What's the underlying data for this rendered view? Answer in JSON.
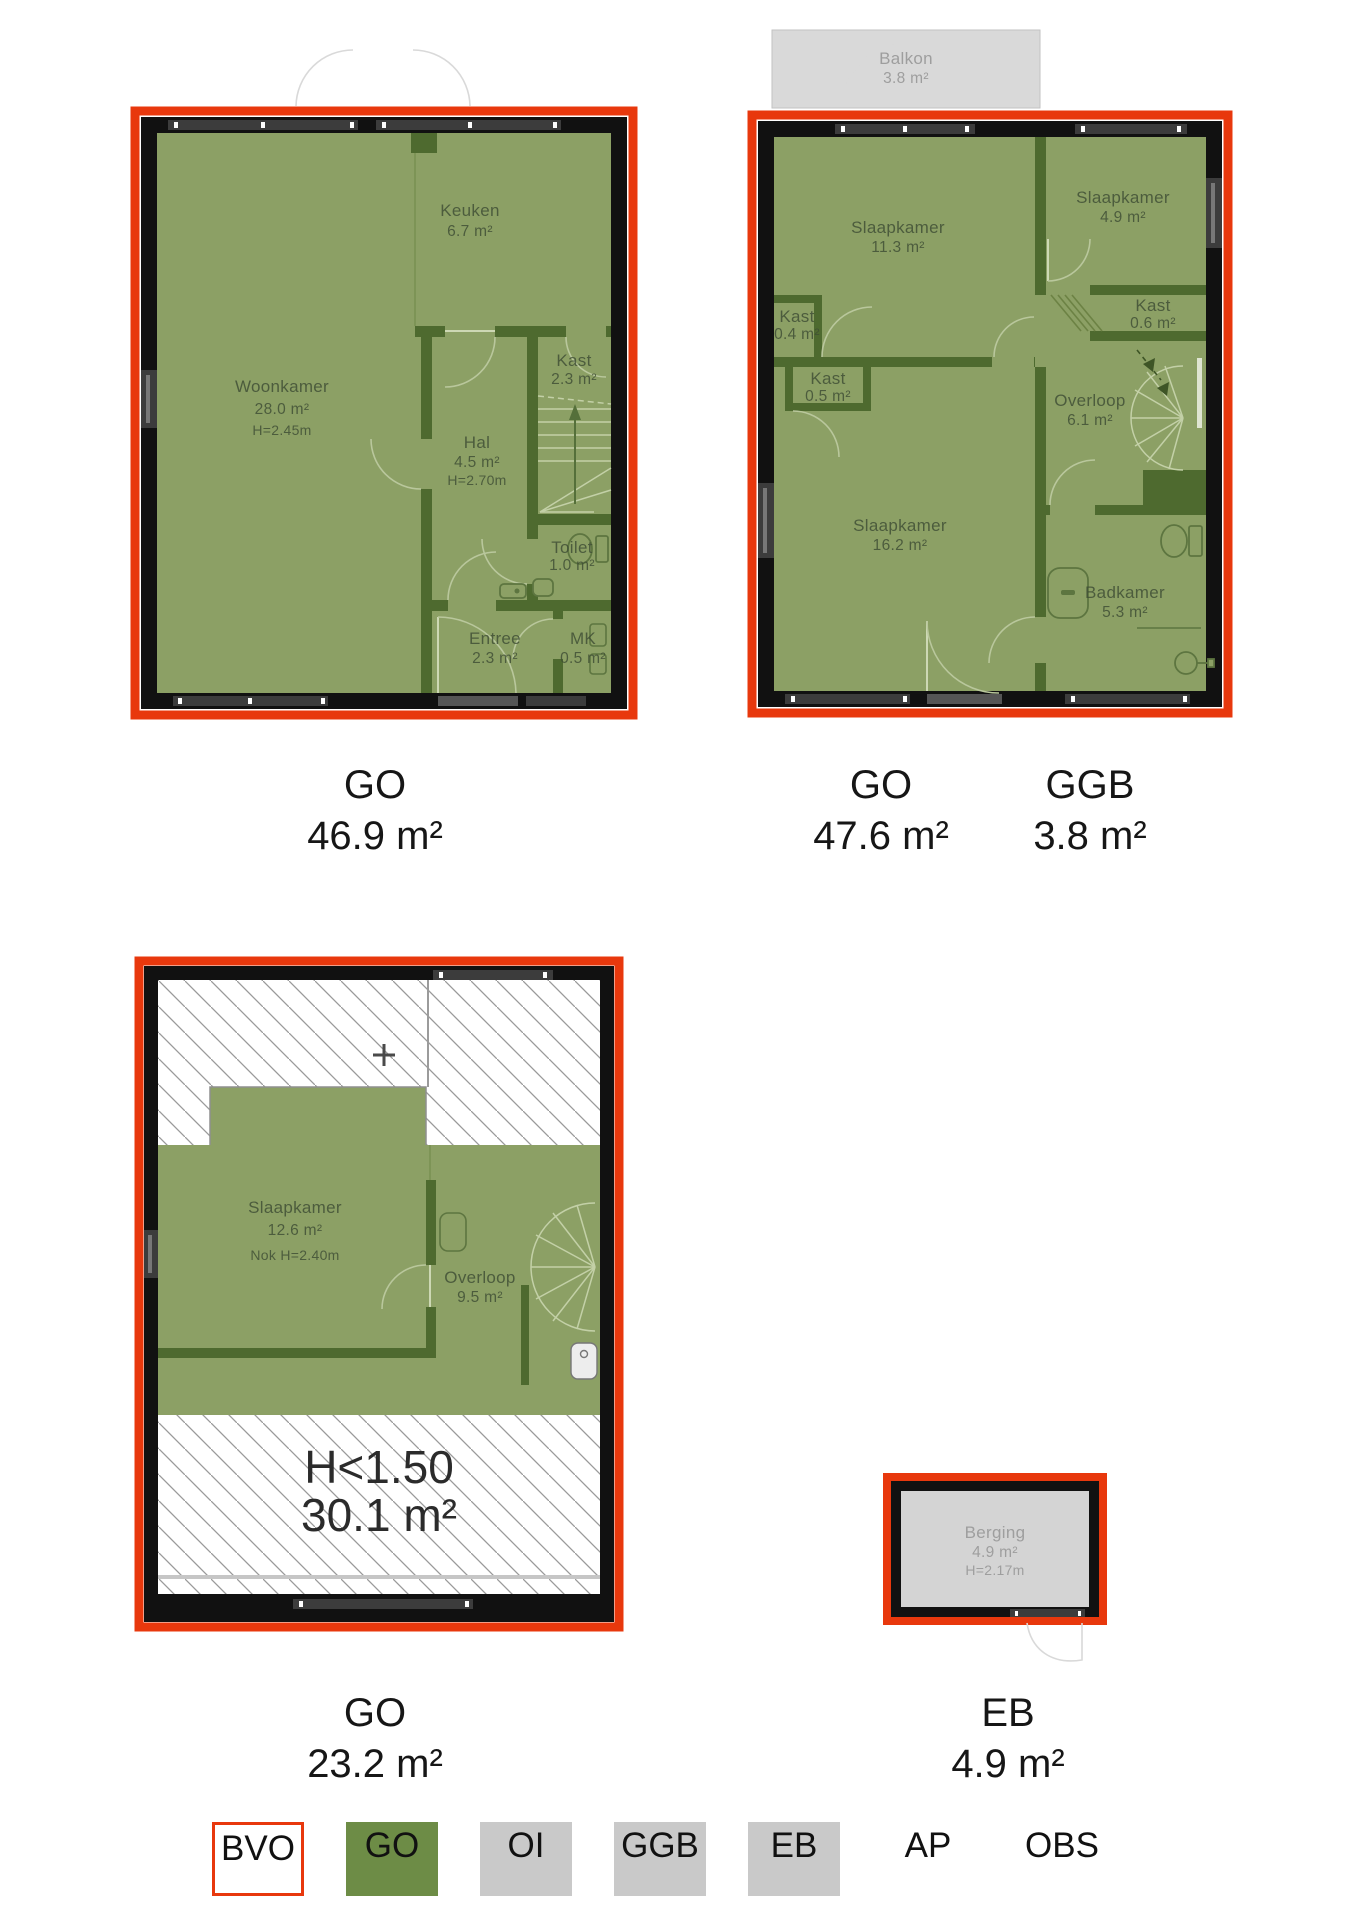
{
  "colors": {
    "red": "#e8380d",
    "floor": "#8ca065",
    "wall": "#4e6a2f",
    "wall_black": "#111111",
    "legend_green": "#6d8c46",
    "legend_gray": "#c9c9c9",
    "balkon_gray": "#d9d9d9",
    "storage_gray": "#d4d4d4"
  },
  "plans": {
    "ground": {
      "caption": [
        {
          "code": "GO",
          "area": "46.9 m²"
        }
      ],
      "rooms": {
        "keuken": {
          "name": "Keuken",
          "area": "6.7 m²"
        },
        "woonkamer": {
          "name": "Woonkamer",
          "area": "28.0 m²",
          "height": "H=2.45m"
        },
        "kast": {
          "name": "Kast",
          "area": "2.3 m²"
        },
        "hal": {
          "name": "Hal",
          "area": "4.5 m²",
          "height": "H=2.70m"
        },
        "toilet": {
          "name": "Toilet",
          "area": "1.0 m²"
        },
        "entree": {
          "name": "Entree",
          "area": "2.3 m²"
        },
        "mk": {
          "name": "MK",
          "area": "0.5 m²"
        }
      }
    },
    "first": {
      "caption": [
        {
          "code": "GO",
          "area": "47.6 m²"
        },
        {
          "code": "GGB",
          "area": "3.8 m²"
        }
      ],
      "rooms": {
        "balkon": {
          "name": "Balkon",
          "area": "3.8 m²"
        },
        "slaapkamer_1": {
          "name": "Slaapkamer",
          "area": "11.3 m²"
        },
        "slaapkamer_2": {
          "name": "Slaapkamer",
          "area": "4.9 m²"
        },
        "kast_1": {
          "name": "Kast",
          "area": "0.4 m²"
        },
        "kast_2": {
          "name": "Kast",
          "area": "0.5 m²"
        },
        "kast_3": {
          "name": "Kast",
          "area": "0.6 m²"
        },
        "overloop": {
          "name": "Overloop",
          "area": "6.1 m²"
        },
        "slaapkamer_3": {
          "name": "Slaapkamer",
          "area": "16.2 m²"
        },
        "badkamer": {
          "name": "Badkamer",
          "area": "5.3 m²"
        }
      }
    },
    "attic": {
      "caption": [
        {
          "code": "GO",
          "area": "23.2 m²"
        }
      ],
      "rooms": {
        "slaapkamer": {
          "name": "Slaapkamer",
          "area": "12.6 m²",
          "height": "Nok H=2.40m"
        },
        "overloop": {
          "name": "Overloop",
          "area": "9.5 m²"
        },
        "low_headroom": {
          "name": "H<1.50",
          "area": "30.1 m²"
        }
      }
    },
    "storage": {
      "caption": [
        {
          "code": "EB",
          "area": "4.9 m²"
        }
      ],
      "rooms": {
        "berging": {
          "name": "Berging",
          "area": "4.9 m²",
          "height": "H=2.17m"
        }
      }
    }
  },
  "legend": {
    "items": [
      {
        "label": "BVO"
      },
      {
        "label": "GO"
      },
      {
        "label": "OI"
      },
      {
        "label": "GGB"
      },
      {
        "label": "EB"
      },
      {
        "label": "AP"
      },
      {
        "label": "OBS"
      }
    ]
  }
}
